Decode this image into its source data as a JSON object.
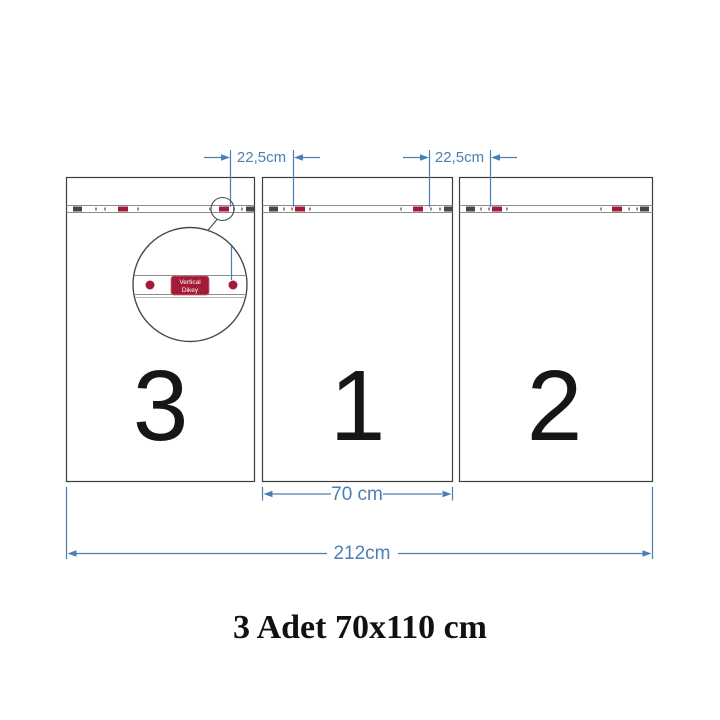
{
  "meta": {
    "colors": {
      "dimension_blue": "#4a7fb5",
      "marker_red": "#a21c38",
      "outline_dark": "#3c3c3c",
      "rail_gray": "#8c8c8c",
      "text_black": "#161616"
    }
  },
  "diagram": {
    "panels": [
      {
        "number": "3"
      },
      {
        "number": "1"
      },
      {
        "number": "2"
      }
    ],
    "dimensions": {
      "hanger_gap_left": "22,5cm",
      "hanger_gap_right": "22,5cm",
      "panel_width": "70 cm",
      "total_width": "212cm"
    },
    "magnifier": {
      "label_line1": "Vertical",
      "label_line2": "Dikey"
    },
    "caption": "3 Adet 70x110 cm"
  }
}
